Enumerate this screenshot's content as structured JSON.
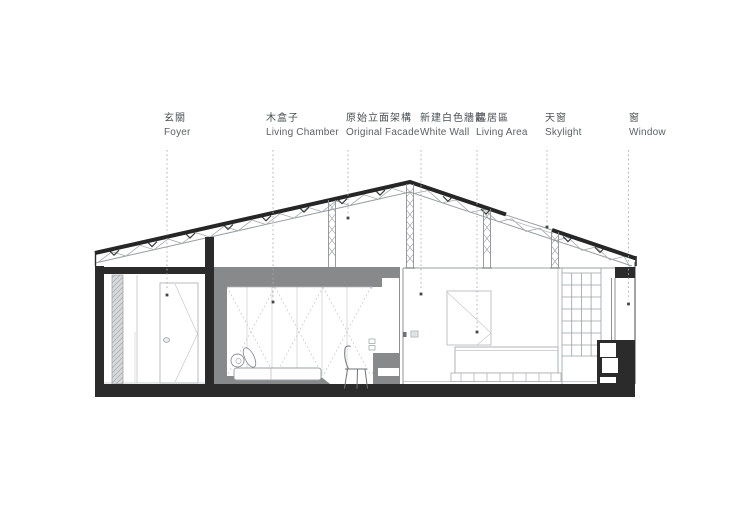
{
  "drawing_title": "Residential long section",
  "colors": {
    "background": "#ffffff",
    "ink_black": "#2b2b2b",
    "box_gray": "#87898b",
    "thin_line": "#9aa0a3",
    "label_text": "#4b5054"
  },
  "labels": [
    {
      "zh": "玄關",
      "en": "Foyer"
    },
    {
      "zh": "木盒子",
      "en": "Living Chamber"
    },
    {
      "zh": "原始立面架構",
      "en": "Original Facade"
    },
    {
      "zh": "新建白色牆體",
      "en": "White Wall"
    },
    {
      "zh": "起居區",
      "en": "Living Area"
    },
    {
      "zh": "天窗",
      "en": "Skylight"
    },
    {
      "zh": "窗",
      "en": "Window"
    }
  ]
}
